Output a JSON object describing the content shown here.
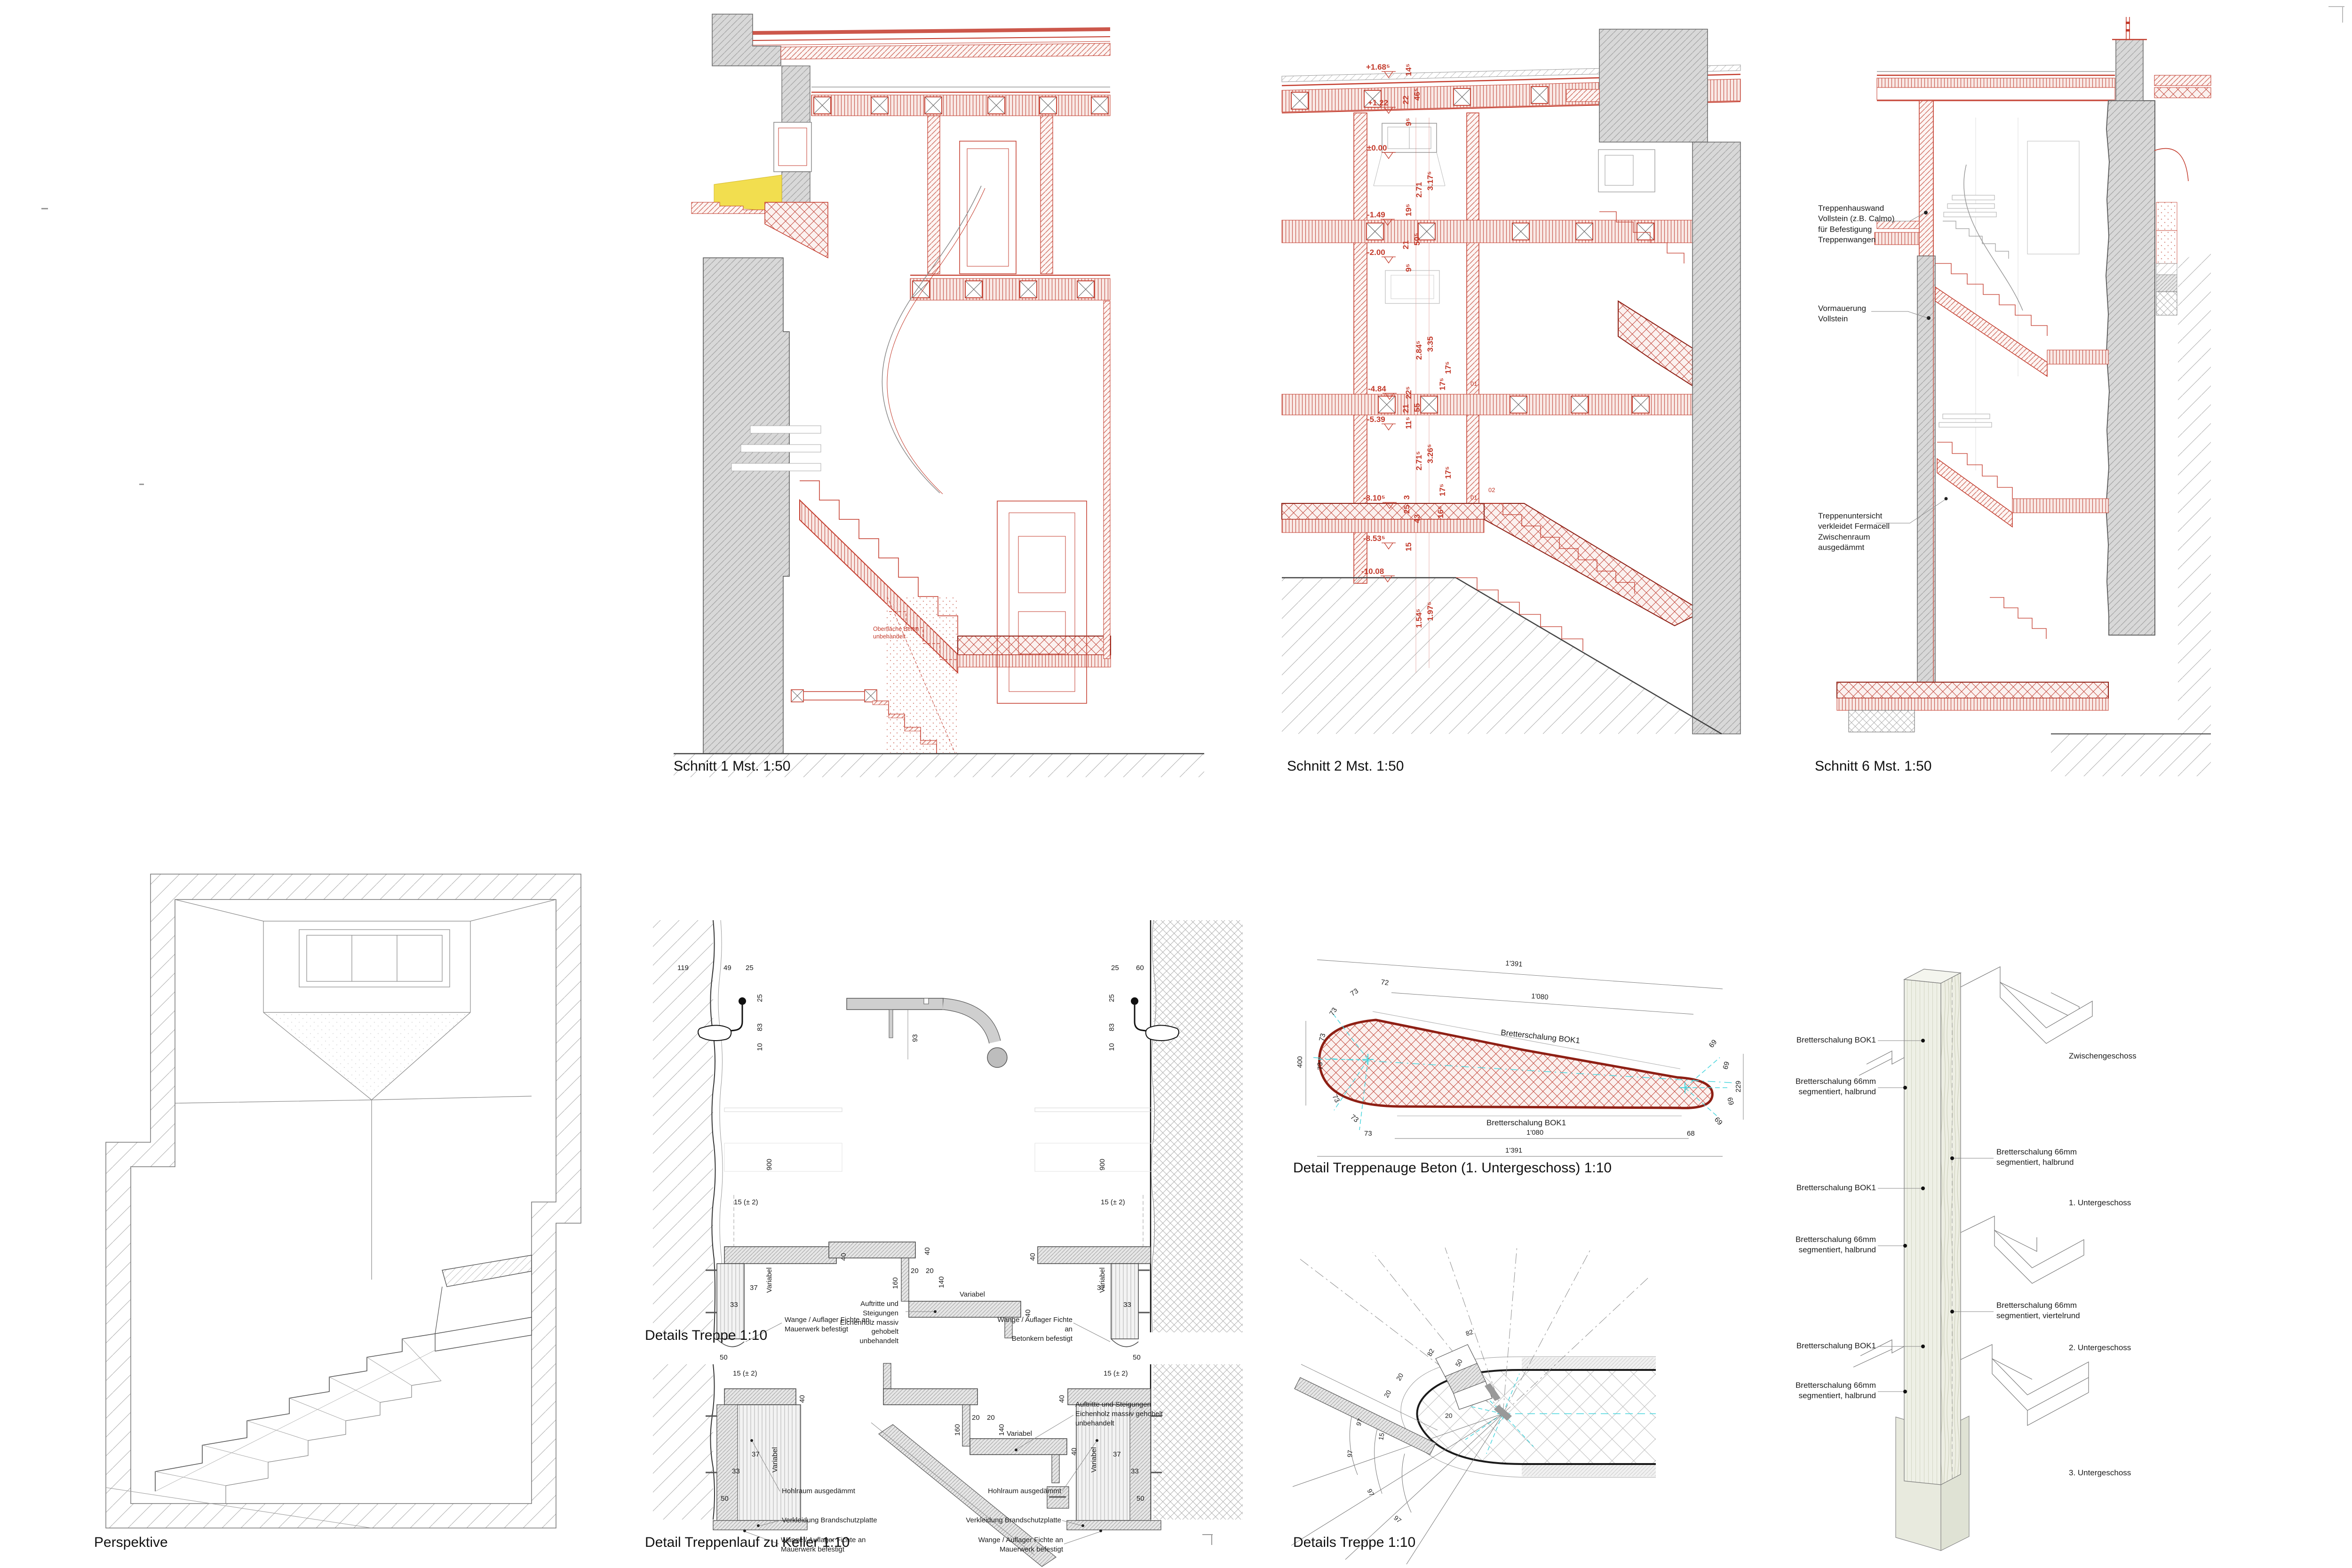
{
  "titles": {
    "schnitt1": "Schnitt 1 Mst. 1:50",
    "schnitt2": "Schnitt 2 Mst. 1:50",
    "schnitt6": "Schnitt 6 Mst. 1:50",
    "perspektive": "Perspektive",
    "details_treppe": "Details Treppe 1:10",
    "detail_keller": "Detail Treppenlauf zu Keller 1:10",
    "treppenauge": "Detail Treppenauge Beton (1. Untergeschoss) 1:10",
    "details_treppe_plan": "Details Treppe 1:10"
  },
  "colors": {
    "red": "#c33a2b",
    "dark_red": "#8e1f14",
    "wall_gray": "#d8d8d8",
    "yellow": "#f2de4f",
    "cyan": "#49d6de",
    "wood": "#edeee3"
  },
  "schnitt1": {
    "note": "Oberfläche Beton\nunbehandelt"
  },
  "schnitt2": {
    "levels": {
      "l1": "+1.68⁵",
      "l2": "+1.22",
      "l3": "±0.00",
      "l4": "-1.49",
      "l5": "-2.00",
      "l6": "-4.84",
      "l7": "-5.39",
      "l8": "-8.10⁵",
      "l9": "-8.53⁵",
      "l10": "-10.08"
    },
    "dims": {
      "v14": "14⁵",
      "v22": "22",
      "v46": "46⁵",
      "v9": "9⁵",
      "v271": "2.71",
      "v317": "3.17⁵",
      "v19": "19⁵",
      "v21": "21",
      "v505": "50⁵",
      "v284": "2.84⁵",
      "v335": "3.35",
      "v17": "17⁵",
      "v225": "22⁵",
      "v55": "55",
      "v11": "11⁵",
      "v2715": "2.71⁵",
      "v326": "3.26⁵",
      "v16": "16⁵",
      "v25": "25",
      "v3": "3",
      "v43": "43",
      "v15": "15",
      "v154": "1.54⁵",
      "v197": "1.97⁵"
    },
    "steps": {
      "s01": "01",
      "s02": "02"
    }
  },
  "schnitt6_annotations": {
    "treppenhauswand": "Treppenhauswand\nVollstein (z.B. Calmo)\nfür Befestigung\nTreppenwangen",
    "vormauerung": "Vormauerung\nVollstein",
    "treppenuntersicht": "Treppenuntersicht\nverkleidet Fermacell\nZwischenraum\nausgedämmt"
  },
  "dims": {
    "v119": "119",
    "v49": "49",
    "v25": "25",
    "v60": "60",
    "v83": "83",
    "v10": "10",
    "v900": "900",
    "v40": "40",
    "v37": "37",
    "v33": "33",
    "v50": "50",
    "v93": "93",
    "v160": "160",
    "v20": "20",
    "v140": "140",
    "v15pm": "15 (± 2)",
    "variabel": "Variabel"
  },
  "details_ann": {
    "wange_mauerwerk": "Wange / Auflager Fichte an\nMauerwerk befestigt",
    "wange_beton": "Wange / Auflager Fichte an\nBetonkern befestigt",
    "auftritte": "Auftritte und Steigungen\nEichenholz massiv gehobelt\nunbehandelt"
  },
  "keller_ann": {
    "hohlraum": "Hohlraum ausgedämmt",
    "verkleidung": "Verkleidung Brandschutzplatte",
    "wange": "Wange / Auflager Fichte an\nMauerwerk befestigt",
    "auftritte": "Auftritte und Steigungen\nEichenholz massiv gehobelt\nunbehandelt"
  },
  "treppenauge": {
    "label_top": "Bretterschalung BOK1",
    "label_bottom": "Bretterschalung BOK1",
    "dims": {
      "o1391": "1'391",
      "i1080": "1'080",
      "v400": "400",
      "v229": "229",
      "v72": "72",
      "v73": "73",
      "v69": "69",
      "v68": "68"
    }
  },
  "plan_detail": {
    "dims": {
      "v82": "82",
      "v97": "97",
      "v50": "50",
      "v20": "20",
      "v15": "15"
    }
  },
  "axo": {
    "left": {
      "a1": "Bretterschalung BOK1",
      "a2": "Bretterschalung 66mm\nsegmentiert, halbrund",
      "a3": "Bretterschalung BOK1",
      "a4": "Bretterschalung 66mm\nsegmentiert, halbrund",
      "a5": "Bretterschalung BOK1",
      "a6": "Bretterschalung 66mm\nsegmentiert, halbrund"
    },
    "right": {
      "zwischengeschoss": "Zwischengeschoss",
      "halbrund": "Bretterschalung 66mm\nsegmentiert, halbrund",
      "ug1": "1. Untergeschoss",
      "viertelrund": "Bretterschalung 66mm\nsegmentiert, viertelrund",
      "ug2": "2. Untergeschoss",
      "ug3": "3. Untergeschoss"
    }
  }
}
